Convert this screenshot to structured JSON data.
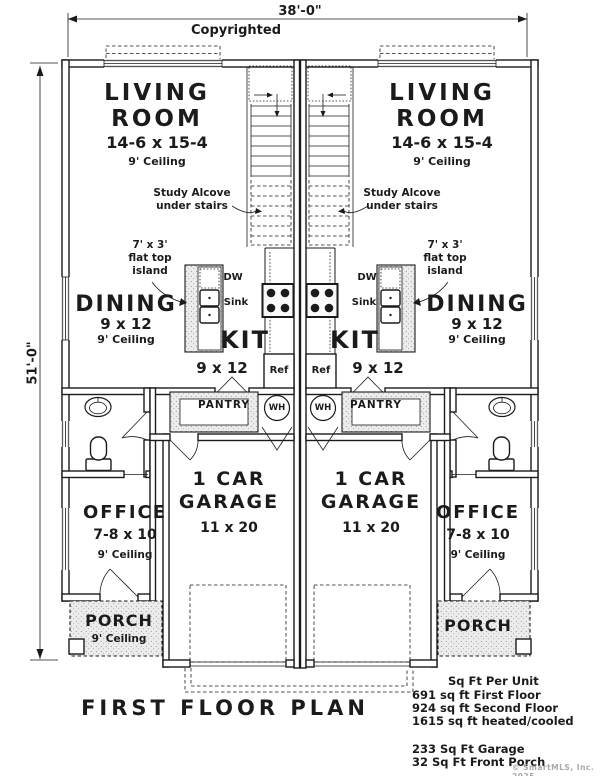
{
  "page": {
    "copyright_note": "Copyrighted",
    "title": "FIRST FLOOR PLAN",
    "watermark": "© SmartMLS, Inc. 2025"
  },
  "dimensions": {
    "width": "38'-0\"",
    "height": "51'-0\""
  },
  "rooms": {
    "living": {
      "line1": "LIVING",
      "line2": "ROOM",
      "dims": "14-6 x 15-4",
      "ceiling": "9' Ceiling"
    },
    "dining": {
      "name": "DINING",
      "dims": "9 x 12",
      "ceiling": "9' Ceiling"
    },
    "kitchen": {
      "name": "KIT",
      "dims": "9 x 12"
    },
    "garage": {
      "line1": "1 CAR",
      "line2": "GARAGE",
      "dims": "11 x 20"
    },
    "office": {
      "name": "OFFICE",
      "dims": "7-8 x 10",
      "ceiling": "9' Ceiling"
    },
    "porch": {
      "name": "PORCH",
      "ceiling": "9' Ceiling"
    },
    "pantry": {
      "name": "PANTRY"
    }
  },
  "annotations": {
    "study_alcove_line1": "Study Alcove",
    "study_alcove_line2": "under stairs",
    "island_line1": "7' x 3'",
    "island_line2": "flat top",
    "island_line3": "island",
    "dw": "DW",
    "sink": "Sink",
    "ref": "Ref",
    "wh": "WH"
  },
  "stats": {
    "header": "Sq Ft Per Unit",
    "first_floor": "691 sq ft First Floor",
    "second_floor": "924 sq ft Second Floor",
    "heated": "1615 sq ft heated/cooled",
    "garage": "233 Sq Ft Garage",
    "front_porch": "32 Sq Ft Front Porch"
  },
  "colors": {
    "line": "#1b1b1b",
    "stipple_fill": "#ececec",
    "watermark": "#a8a8a8"
  }
}
